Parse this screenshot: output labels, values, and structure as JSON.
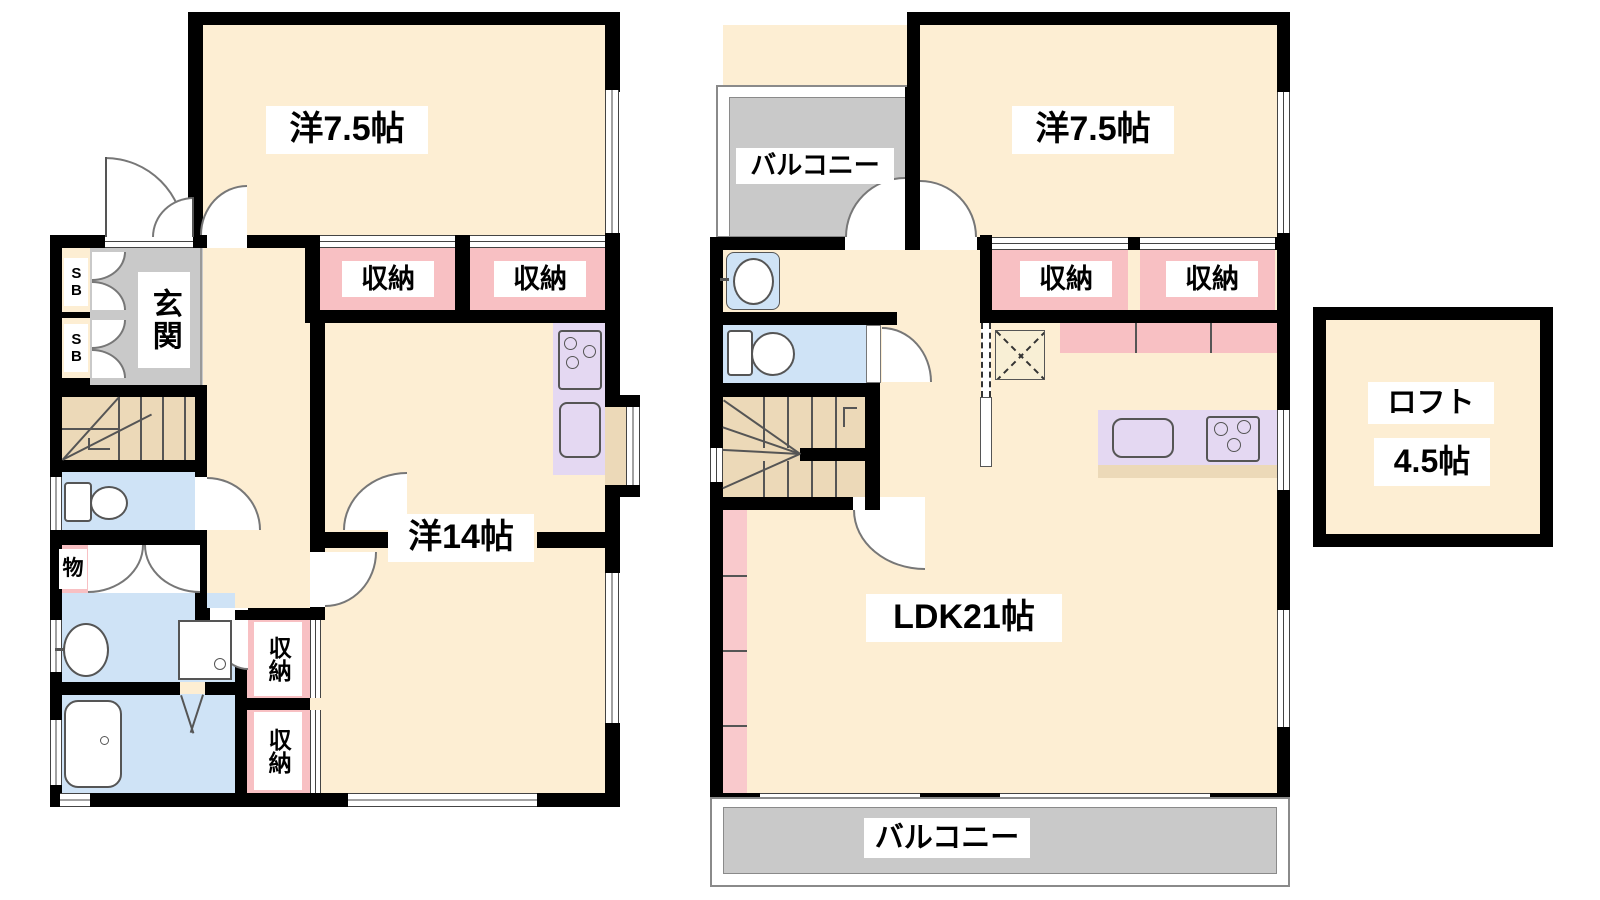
{
  "floor1": {
    "room1_label": "洋7.5帖",
    "storage_label": "収納",
    "entrance_label": "玄関",
    "shoebox_label": "SB",
    "closet_label": "物",
    "room2_label": "洋14帖"
  },
  "floor2": {
    "room1_label": "洋7.5帖",
    "storage_label": "収納",
    "balcony_label": "バルコニー",
    "ldk_label": "LDK21帖",
    "loft_label": "ロフト",
    "loft_size_label": "4.5帖"
  },
  "colors": {
    "wall": "#000000",
    "room_fill": "#fdeed3",
    "closet_fill": "#f8c0c3",
    "wet_area_fill": "#cfe3f6",
    "kitchen_fill": "#e4d8f2",
    "stairs_fill": "#ecd9b8",
    "balcony_fill": "#c9c9c9",
    "label_bg": "#ffffff"
  }
}
